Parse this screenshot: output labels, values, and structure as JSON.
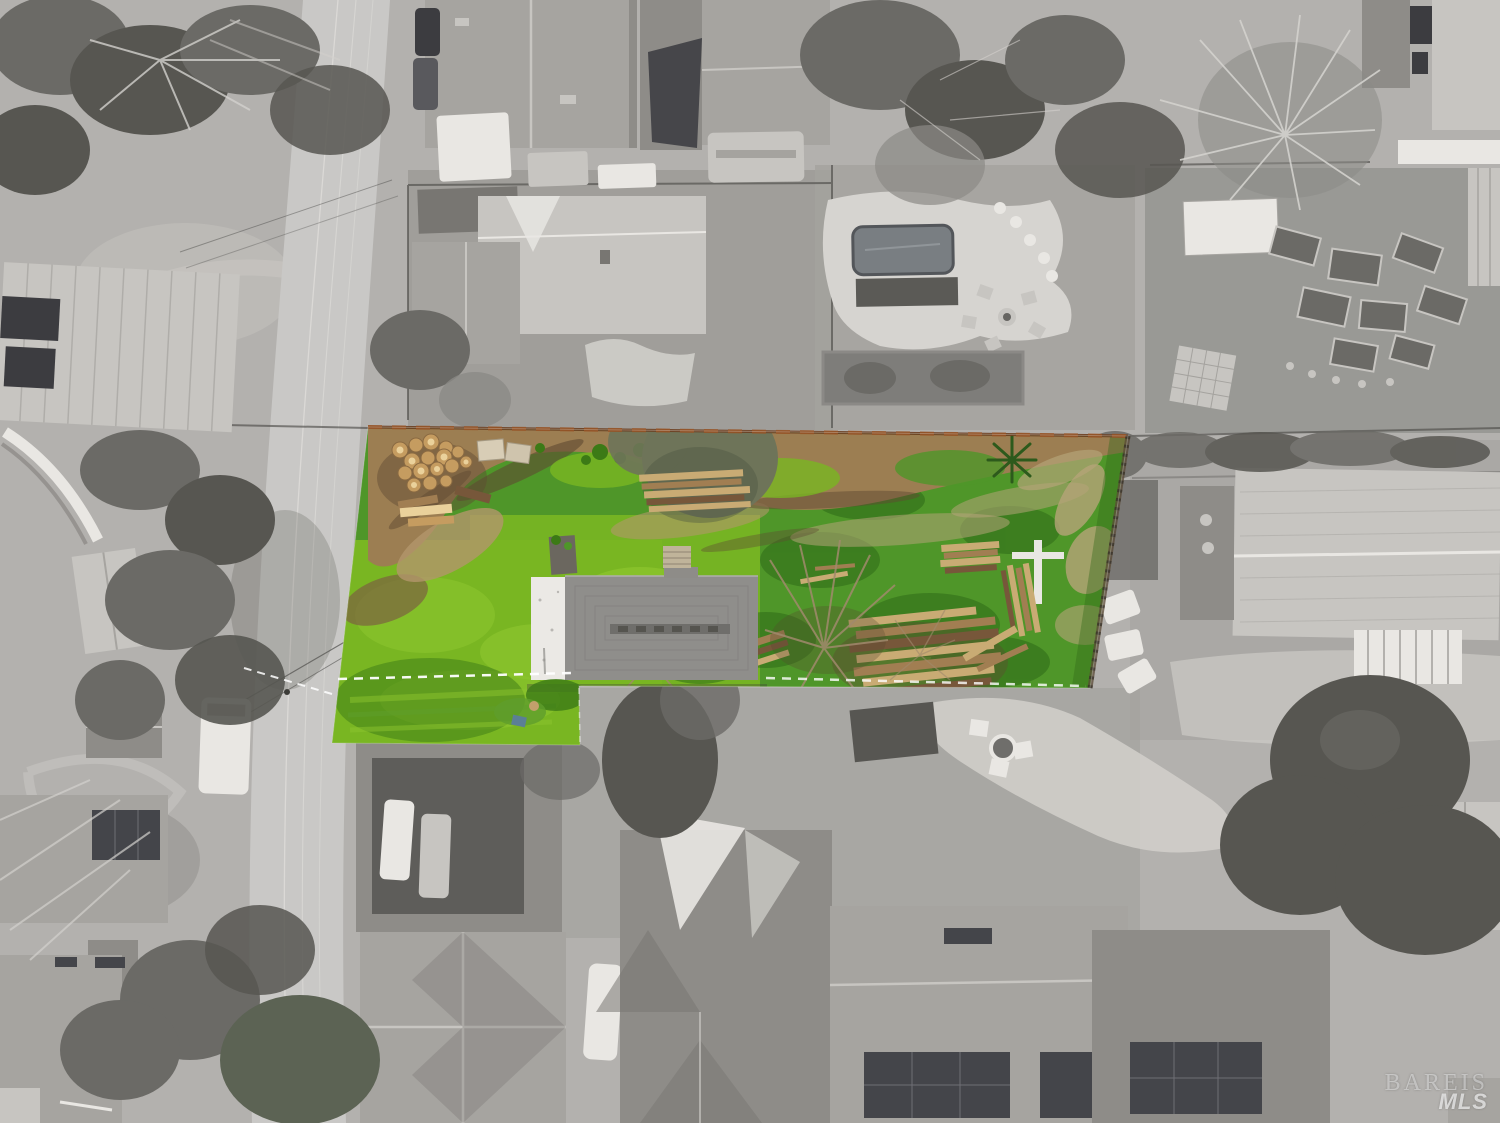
{
  "image": {
    "kind": "aerial drone photograph (top-down)",
    "treatment": "neighborhood desaturated to grayscale; the listed vacant lot is shown in full color",
    "canvas": {
      "width": 1500,
      "height": 1123
    }
  },
  "watermark": {
    "brand": "BAREIS",
    "sub": "MLS"
  },
  "highlighted_parcel": {
    "shape": "flag-shaped lot fronting the street, long strip running east with a rear notch at the southwest",
    "features": [
      "bare-dirt band along the north fence line",
      "pile of cut logs and stumps at the northwest corner",
      "single-story house with gray shingle roof and white flat-roof section",
      "brick chimney and porch steps on the north side",
      "stacked lumber piles in the east yard with white boards and ladder",
      "yucca plant",
      "bare winter trees over the east half",
      "bright green lawn on the west half, clover cover on the east",
      "white dashed lot line along the street-side boundary",
      "rust-brown wood fence along the north and east boundaries"
    ]
  },
  "surroundings": [
    "street running diagonally along the west side with power lines and parked cars",
    "white van and shed west of the street",
    "backyard with lap pool, flagstone patio and fire pit north of the lot",
    "raised garden beds and white shed in the northeast yard",
    "large house with deck and white pergola east of the lot",
    "houses with rooftop solar panels to the south",
    "carport with two white cars south of the lot",
    "large bare winter trees throughout"
  ],
  "palette": {
    "ground": "#b3b1ae",
    "ground_dark": "#8f8e8a",
    "ground_mid": "#a4a29e",
    "sand": "#d2d0cb",
    "road": "#c9c8c6",
    "roof_light": "#c7c5c1",
    "roof_mid": "#a6a4a0",
    "roof_dark": "#8e8c88",
    "roof_deep": "#787672",
    "white": "#e9e7e3",
    "window": "#3c3c40",
    "tarp": "#46464a",
    "tree_dark": "#575651",
    "tree_mid": "#6b6a66",
    "tree_light": "#8b8a86",
    "branch_light": "#d3d1cd",
    "olive": "#6e7459",
    "solar": "#44454a",
    "pool": "#797e82",
    "stone": "#d6d4d0",
    "grass": "#79b622",
    "grass_light": "#8cc42e",
    "grass_mid": "#5f9e2c",
    "grass_dark": "#3c7a16",
    "clover": "#4f9629",
    "clover_dark": "#2f6b18",
    "dirt": "#9c7e52",
    "dirt_light": "#b3966b",
    "dirt_dark": "#7c6140",
    "soil": "#5f4a32",
    "dry_brush": "#b5a478",
    "log": "#c59c60",
    "log_end": "#ead19b",
    "lumber": "#c9ab74",
    "lumber_mid": "#a17e52",
    "lumber_dark": "#77573a",
    "fence_rust": "#9a5526",
    "fence_brown": "#6b3d1f",
    "house_roof": "#8f8e8b",
    "house_ridge": "#6f6e6b",
    "house_white": "#ebe9e5",
    "branch_tan": "#a08a6c",
    "yucca": "#2d5a1c",
    "tarp_blue": "#5b7f96",
    "dash": "#ffffff",
    "wm": "rgba(232,232,232,0.55)",
    "wm2": "rgba(244,244,244,0.72)"
  }
}
